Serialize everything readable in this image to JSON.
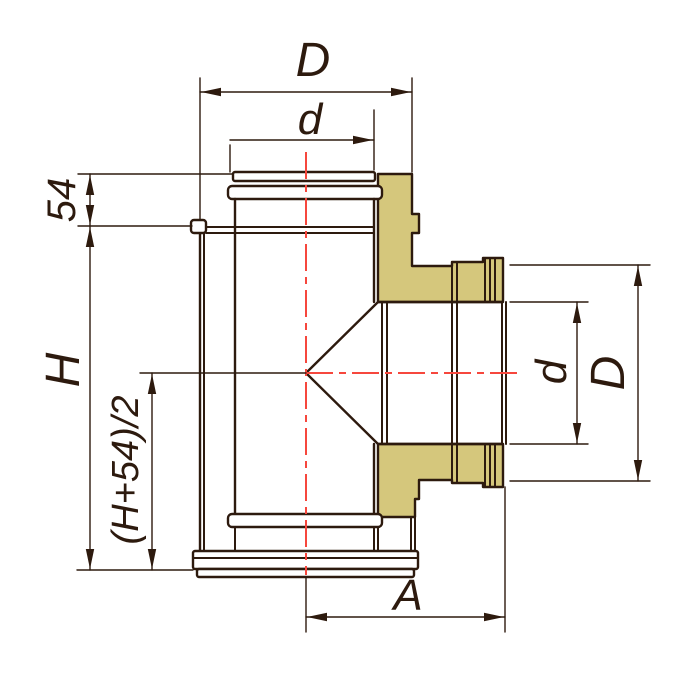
{
  "drawing": {
    "labels": {
      "dim_top_outer": "D",
      "dim_top_inner": "d",
      "dim_spigot": "54",
      "dim_height": "H",
      "dim_branch_axis": "(H+54)/2",
      "dim_branch_length": "A",
      "dim_side_inner": "d",
      "dim_side_outer": "D"
    },
    "colors": {
      "line": "#2d1a0e",
      "insulation": "#d5c77c",
      "centerline": "#f6473d",
      "background": "#ffffff"
    }
  }
}
